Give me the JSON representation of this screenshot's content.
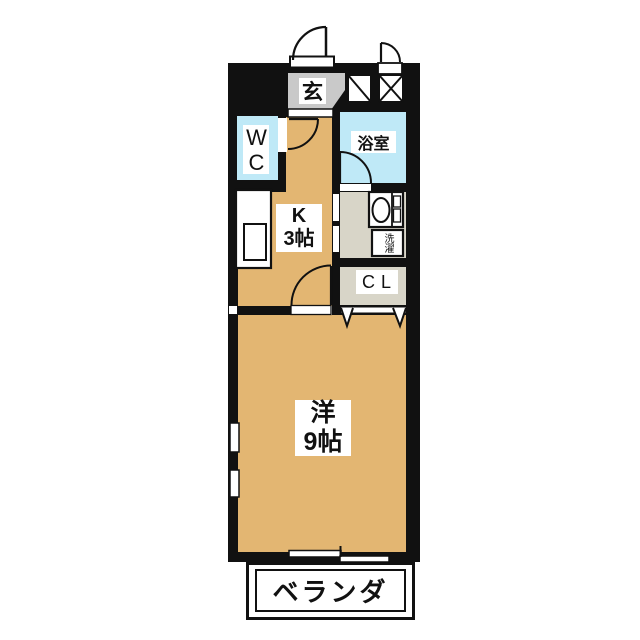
{
  "floorplan": {
    "entrance_label": "玄",
    "wc_label": "WC",
    "bathroom_label": "浴室",
    "kitchen_label": "K\n3帖",
    "laundry_label": "洗濯",
    "closet_label": "CL",
    "main_room_label": "洋\n9帖",
    "veranda_label": "ベランダ",
    "colors": {
      "wall": "#111111",
      "room_floor": "#e3b672",
      "wet_room_floor": "#bfe9f7",
      "entrance_floor": "#c9c9c9",
      "utility_floor": "#d8d5c8",
      "background": "#ffffff"
    }
  }
}
